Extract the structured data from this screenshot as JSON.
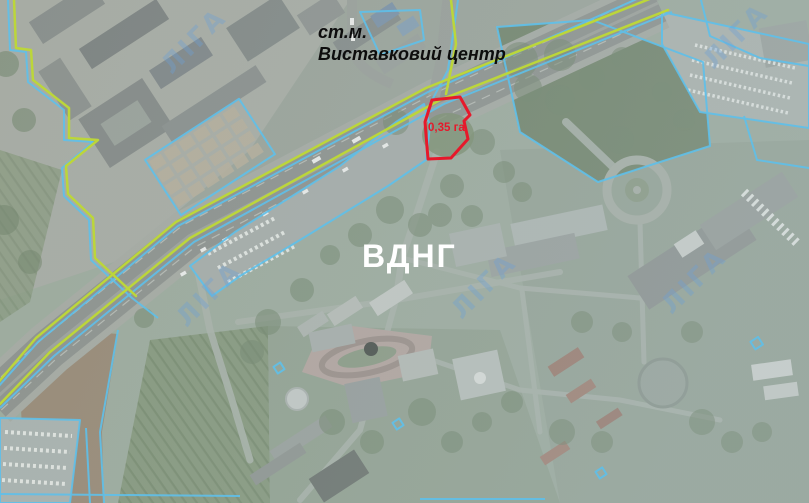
{
  "map": {
    "labels": {
      "metro_line1": "ст.м.",
      "metro_line2": "Виставковий центр",
      "site_name": "ВДНГ",
      "plot_area": "0,35 га"
    },
    "watermark": {
      "text": "ЛІГА"
    },
    "colors": {
      "plot_red": "#e6192b",
      "boundary_cyan": "#5fc0ea",
      "boundary_green": "#bcd63a",
      "label_black": "#0d0d0d",
      "site_white": "#ffffff",
      "watermark_blue": "#6ba0d8"
    }
  }
}
